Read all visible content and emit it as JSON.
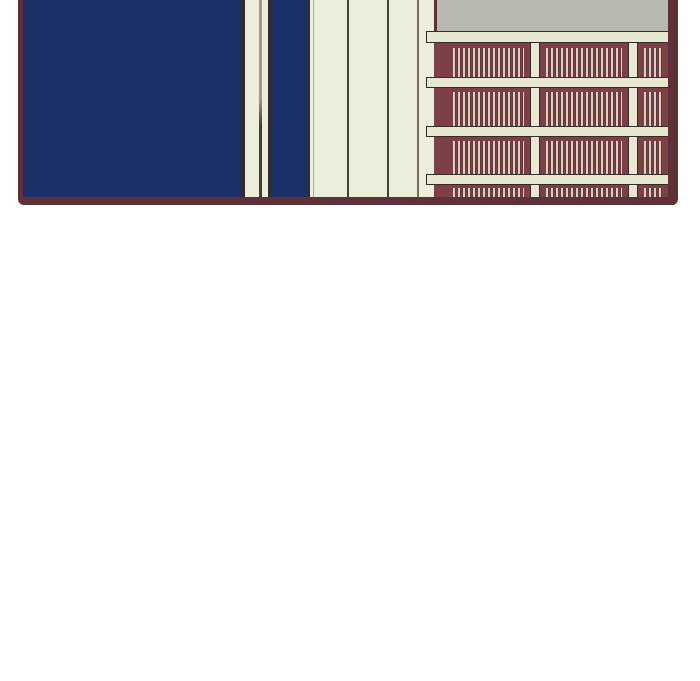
{
  "page": {
    "width": 700,
    "height": 681,
    "background": "#ffffff"
  },
  "scene": {
    "type": "webtoon-comic-panel",
    "description": "Single comic panel, cropped at the top edge: interior room with a large dark navy wall on the left, a cream paneled wall in the middle, and a maroon bookshelf filled with rows of books on the right; gray wall strip above the shelf; blank white page space below the panel",
    "panel_count": 1,
    "text_content": "none"
  },
  "colors": {
    "white_bg": "#ffffff",
    "navy": "#1a3067",
    "border_maroon": "#5e3037",
    "shelf_maroon": "#7c4046",
    "cream_wall": "#ebeeda",
    "cream_board": "#e7e8d4",
    "cream_book": "#d9d3c2",
    "gray_wall": "#b7bab0",
    "outline_dark": "#362b29",
    "panel_line_dark": "#474039",
    "panel_line_medium": "#7b6a5a",
    "panel_line_faint": "#b5a48f",
    "corner_line_top": "#ab947f",
    "corner_line_bottom": "#453a31"
  },
  "bookshelf": {
    "shelf_row_count": 4,
    "bay_count": 3,
    "boards": [
      {
        "top": 0,
        "height": 12
      },
      {
        "top": 46,
        "height": 11
      },
      {
        "top": 95,
        "height": 11
      },
      {
        "top": 143,
        "height": 11
      }
    ],
    "posts": [
      {
        "left": 96,
        "width": 10
      },
      {
        "left": 194,
        "width": 10
      }
    ],
    "bays": [
      {
        "left": 13,
        "width": 83
      },
      {
        "left": 106,
        "width": 88
      },
      {
        "left": 204,
        "width": 30
      }
    ],
    "rows": [
      {
        "top": 12,
        "height": 34,
        "book_top_gap": 5
      },
      {
        "top": 57,
        "height": 38,
        "book_top_gap": 4
      },
      {
        "top": 106,
        "height": 37,
        "book_top_gap": 4
      },
      {
        "top": 154,
        "height": 12,
        "book_top_gap": 3
      }
    ]
  }
}
